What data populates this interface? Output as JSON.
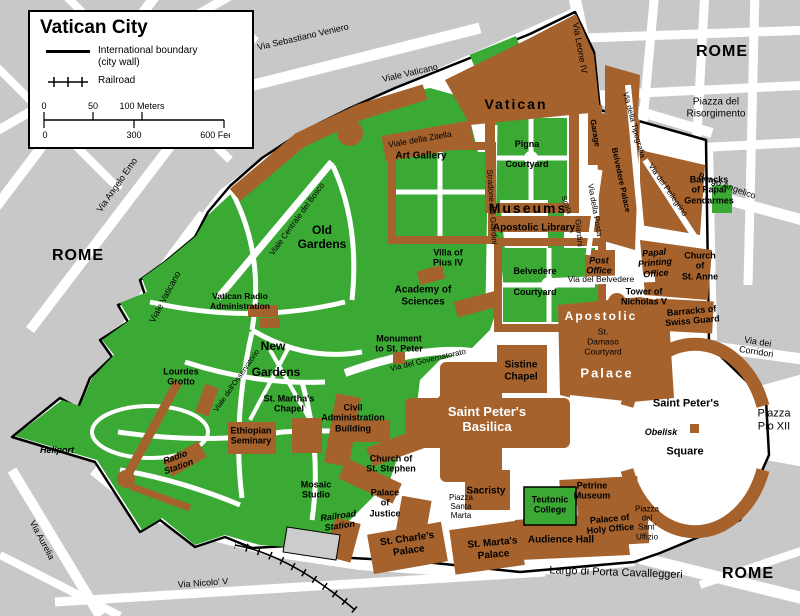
{
  "legend": {
    "title": "Vatican City",
    "boundary": "International boundary\n(city wall)",
    "railroad": "Railroad",
    "scale": {
      "m0": "0",
      "m50": "50",
      "m100": "100 Meters",
      "f0": "0",
      "f300": "300",
      "f600": "600 Feet"
    }
  },
  "colors": {
    "garden_green": "#3aaa35",
    "building_brown": "#a5622d",
    "block_gray": "#c8c8c8",
    "street_white": "#ffffff",
    "boundary_black": "#000000"
  },
  "regions": {
    "rome_west": "ROME",
    "rome_northeast": "ROME",
    "rome_southeast": "ROME",
    "vatican": "Vatican",
    "museums": "Museums",
    "old_gardens": "Old\nGardens",
    "new": "New",
    "gardens": "Gardens",
    "apostolic": "Apostolic",
    "palace": "Palace",
    "saint_peters_basilica": "Saint Peter's\nBasilica",
    "saint_peters": "Saint Peter's",
    "square": "Square",
    "piazza_pio_xii": "Piazza\nPio XII",
    "piazza_del_risorgimento": "Piazza del\nRisorgimento",
    "piazza_santa_marta": "Piazza\nSanta\nMarta",
    "piazza_del_sant_uffizio": "Piazza\ndel\nSant'\nUffizio",
    "st_damaso_courtyard": "St.\nDamaso\nCourtyard",
    "pigna_courtyard": "Pigna\nCourtyard",
    "belvedere_courtyard": "Belvedere\nCourtyard"
  },
  "streets": {
    "via_sebastiano_veniero": "Via Sebastiano Veniero",
    "viale_vaticano_top": "Viale Vaticano",
    "viale_vaticano_west": "Viale Vaticano",
    "via_leone_iv": "Via Leone IV",
    "borgo_angelico": "Borgo Angelico",
    "via_angelo_emo": "Via Angelo Emo",
    "via_dei_corridori": "Via dei Corridori",
    "via_aurelia": "Via Aurelia",
    "via_nicolo_v": "Via Nicolo' V",
    "largo_di_porta_cavalleggeri": "Largo di Porta Cavalleggeri",
    "viale_della_zitella": "Viale della Zitella",
    "viale_centrale_del_bosco": "Viale Centrale del Bosco",
    "stradone_dei_giardini": "Stradone dei Giardini",
    "via_del_governatorato": "Via del Governatorato",
    "via_del_belvedere": "Via del Belvedere",
    "via_della_posta": "Via della Posta",
    "via_della_tipografia": "Via della Tipografia",
    "via_del_pellegrino": "Via del Pellegrino",
    "viale_dell_osservatorio": "Viale dell'Osservatorio",
    "scala": "Scala",
    "giardini": "Giardini"
  },
  "sites": {
    "art_gallery": "Art Gallery",
    "apostolic_library": "Apostolic Library",
    "villa_of_pius_iv": "Villa of\nPius IV",
    "academy_of_sciences": "Academy of\nSciences",
    "vatican_radio_administration": "Vatican Radio\nAdministration",
    "monument_to_st_peter": "Monument\nto St. Peter",
    "lourdes_grotto": "Lourdes\nGrotto",
    "heliport": "Heliport",
    "radio_station": "Radio\nStation",
    "ethiopian_seminary": "Ethiopian\nSeminary",
    "st_marthas_chapel": "St. Martha's\nChapel",
    "civil_administration_building": "Civil\nAdministration\nBuilding",
    "church_of_st_stephen": "Church of\nSt. Stephen",
    "mosaic_studio": "Mosaic\nStudio",
    "palace_of_justice": "Palace\nof\nJustice",
    "railroad_station": "Railroad\nStation",
    "st_charles_palace": "St. Charle's\nPalace",
    "st_martas_palace": "St. Marta's\nPalace",
    "sacristy": "Sacristy",
    "teutonic_college": "Teutonic\nCollege",
    "petrine_museum": "Petrine\nMuseum",
    "palace_of_holy_office": "Palace of\nHoly Office",
    "audience_hall": "Audience Hall",
    "tower_of_nicholas_v": "Tower of\nNicholas V",
    "barracks_of_swiss_guard": "Barracks of\nSwiss Guard",
    "barracks_of_papal_gendarmes": "Barracks\nof Papal\nGendarmes",
    "post_office": "Post\nOffice",
    "papal_printing_office": "Papal\nPrinting\nOffice",
    "church_of_st_anne": "Church\nof\nSt. Anne",
    "sistine_chapel": "Sistine\nChapel",
    "garage": "Garage",
    "belvedere_palace": "Belvedere Palace",
    "obelisk": "Obelisk"
  }
}
